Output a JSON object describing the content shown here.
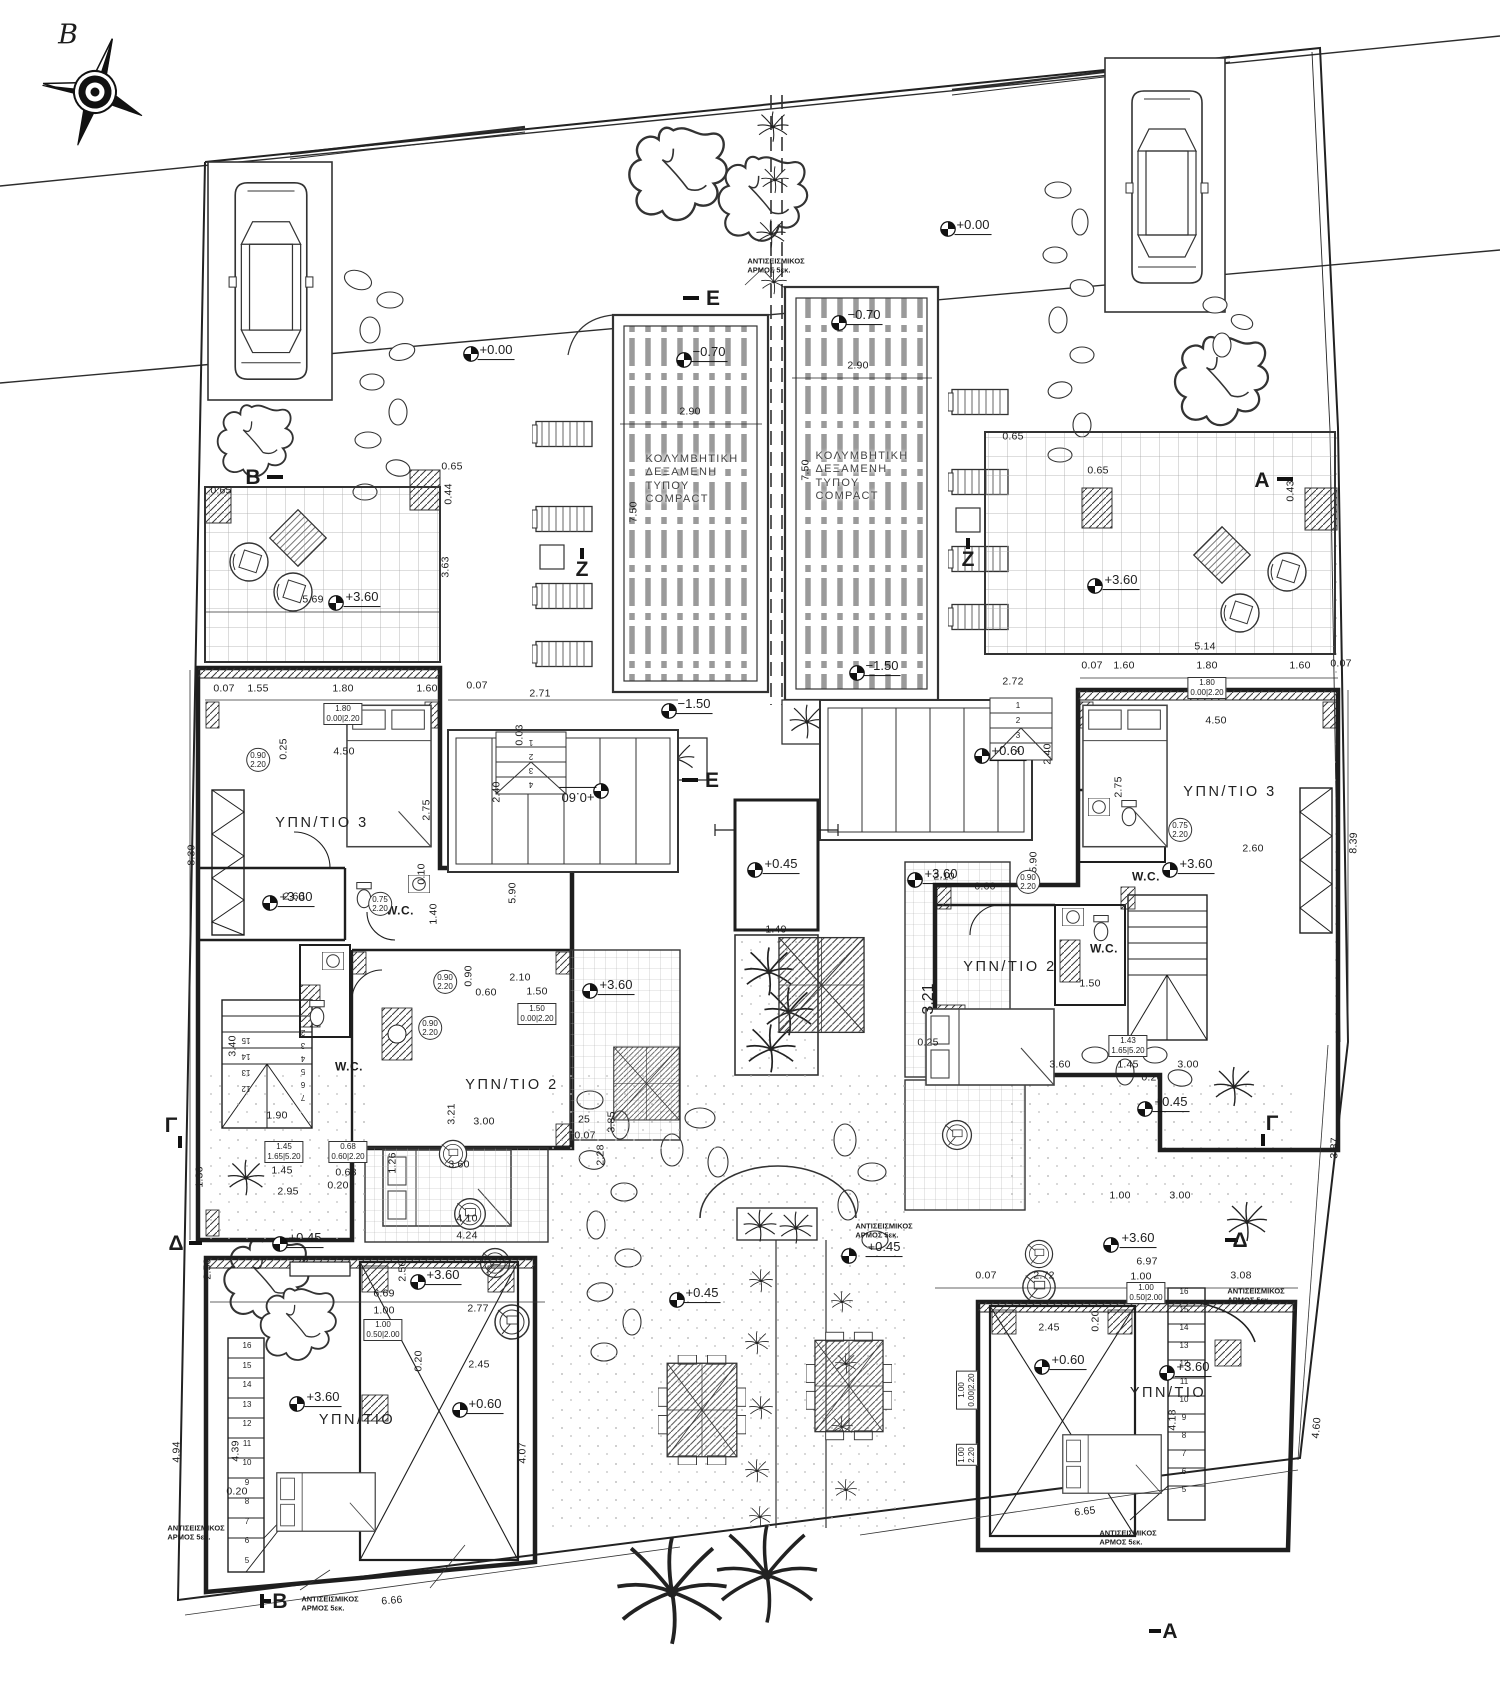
{
  "drawing": {
    "type": "architectural-floor-plan",
    "pool_label": "ΚΟΛΥΜΒΗΤΙΚΗ\nΔΕΞΑΜΕΝΗ\nΤΥΠΟΥ\nCOMPACT",
    "seismic_note": "ΑΝΤΙΣΕΙΣΜΙΚΟΣ\nΑΡΜΟΣ 5εκ.",
    "north_label": "B"
  },
  "annotations": [
    {
      "t": "B",
      "x": 68,
      "y": 36,
      "c": "north",
      "n": "north-label"
    },
    {
      "t": "B",
      "x": 253,
      "y": 478,
      "c": "sec",
      "n": "section-marker-b-top"
    },
    {
      "t": "B",
      "x": 280,
      "y": 1602,
      "c": "sec",
      "n": "section-marker-b-bottom"
    },
    {
      "t": "A",
      "x": 1262,
      "y": 481,
      "c": "sec",
      "n": "section-marker-a-top"
    },
    {
      "t": "A",
      "x": 1170,
      "y": 1632,
      "c": "sec",
      "n": "section-marker-a-bottom"
    },
    {
      "t": "Γ",
      "x": 171,
      "y": 1126,
      "c": "sec",
      "n": "section-marker-g-left"
    },
    {
      "t": "Γ",
      "x": 1272,
      "y": 1124,
      "c": "sec",
      "n": "section-marker-g-right"
    },
    {
      "t": "Δ",
      "x": 176,
      "y": 1244,
      "c": "sec",
      "n": "section-marker-d-left"
    },
    {
      "t": "Δ",
      "x": 1240,
      "y": 1241,
      "c": "sec",
      "n": "section-marker-d-right"
    },
    {
      "t": "E",
      "x": 713,
      "y": 299,
      "c": "sec",
      "n": "section-marker-e-top"
    },
    {
      "t": "E",
      "x": 712,
      "y": 781,
      "c": "sec",
      "n": "section-marker-e-mid"
    },
    {
      "t": "Z",
      "x": 582,
      "y": 570,
      "c": "sec",
      "n": "section-marker-z-left"
    },
    {
      "t": "Z",
      "x": 968,
      "y": 560,
      "c": "sec",
      "n": "section-marker-z-right"
    },
    {
      "t": "+0.00",
      "x": 973,
      "y": 226,
      "c": "lvl"
    },
    {
      "t": "+0.00",
      "x": 496,
      "y": 351,
      "c": "lvl"
    },
    {
      "t": "−0.70",
      "x": 709,
      "y": 353,
      "c": "lvl"
    },
    {
      "t": "−0.70",
      "x": 864,
      "y": 316,
      "c": "lvl"
    },
    {
      "t": "−1.50",
      "x": 694,
      "y": 705,
      "c": "lvl"
    },
    {
      "t": "−1.50",
      "x": 882,
      "y": 667,
      "c": "lvl"
    },
    {
      "t": "+3.60",
      "x": 362,
      "y": 598,
      "c": "lvl"
    },
    {
      "t": "+3.60",
      "x": 1121,
      "y": 581,
      "c": "lvl"
    },
    {
      "t": "+3.60",
      "x": 296,
      "y": 898,
      "c": "lvl"
    },
    {
      "t": "+3.60",
      "x": 616,
      "y": 986,
      "c": "lvl"
    },
    {
      "t": "+3.60",
      "x": 941,
      "y": 875,
      "c": "lvl"
    },
    {
      "t": "+3.60",
      "x": 1196,
      "y": 865,
      "c": "lvl"
    },
    {
      "t": "+0.60",
      "x": 578,
      "y": 796,
      "c": "lvl",
      "r": 180
    },
    {
      "t": "+0.60",
      "x": 1008,
      "y": 752,
      "c": "lvl"
    },
    {
      "t": "+0.45",
      "x": 781,
      "y": 865,
      "c": "lvl"
    },
    {
      "t": "+0.45",
      "x": 305,
      "y": 1239,
      "c": "lvl"
    },
    {
      "t": "+0.45",
      "x": 702,
      "y": 1294,
      "c": "lvl"
    },
    {
      "t": "+0.45",
      "x": 884,
      "y": 1248,
      "c": "lvl"
    },
    {
      "t": "+0.45",
      "x": 1171,
      "y": 1103,
      "c": "lvl"
    },
    {
      "t": "+3.60",
      "x": 323,
      "y": 1398,
      "c": "lvl"
    },
    {
      "t": "+3.60",
      "x": 443,
      "y": 1276,
      "c": "lvl"
    },
    {
      "t": "+0.60",
      "x": 485,
      "y": 1405,
      "c": "lvl"
    },
    {
      "t": "+3.60",
      "x": 1138,
      "y": 1239,
      "c": "lvl"
    },
    {
      "t": "+0.60",
      "x": 1068,
      "y": 1361,
      "c": "lvl"
    },
    {
      "t": "+3.60",
      "x": 1193,
      "y": 1368,
      "c": "lvl"
    },
    {
      "t": "ΥΠΝ/ΤΙΟ 3",
      "x": 322,
      "y": 824,
      "c": "room"
    },
    {
      "t": "ΥΠΝ/ΤΙΟ 3",
      "x": 1230,
      "y": 793,
      "c": "room"
    },
    {
      "t": "ΥΠΝ/ΤΙΟ 2",
      "x": 512,
      "y": 1086,
      "c": "room"
    },
    {
      "t": "ΥΠΝ/ΤΙΟ 2",
      "x": 1010,
      "y": 968,
      "c": "room"
    },
    {
      "t": "ΥΠΝ/ΤΙΟ",
      "x": 357,
      "y": 1421,
      "c": "room"
    },
    {
      "t": "ΥΠΝ/ΤΙΟ",
      "x": 1168,
      "y": 1394,
      "c": "room"
    },
    {
      "t": "W.C.",
      "x": 400,
      "y": 911,
      "c": "roomS"
    },
    {
      "t": "W.C.",
      "x": 349,
      "y": 1067,
      "c": "roomS"
    },
    {
      "t": "W.C.",
      "x": 1146,
      "y": 877,
      "c": "roomS"
    },
    {
      "t": "W.C.",
      "x": 1104,
      "y": 949,
      "c": "roomS"
    },
    {
      "t": "ΚΟΛΥΜΒΗΤΙΚΗ\nΔΕΞΑΜΕΝΗ\nΤΥΠΟΥ\nCOMPACT",
      "x": 692,
      "y": 480,
      "c": "pool",
      "n": "pool-label-left"
    },
    {
      "t": "ΚΟΛΥΜΒΗΤΙΚΗ\nΔΕΞΑΜΕΝΗ\nΤΥΠΟΥ\nCOMPACT",
      "x": 862,
      "y": 477,
      "c": "pool",
      "n": "pool-label-right"
    },
    {
      "t": "ΑΝΤΙΣΕΙΣΜΙΚΟΣ\nΑΡΜΟΣ 5εκ.",
      "x": 776,
      "y": 266,
      "c": "note",
      "n": "seismic-note"
    },
    {
      "t": "ΑΝΤΙΣΕΙΣΜΙΚΟΣ\nΑΡΜΟΣ 5εκ.",
      "x": 330,
      "y": 1604,
      "c": "note",
      "n": "seismic-note"
    },
    {
      "t": "ΑΝΤΙΣΕΙΣΜΙΚΟΣ\nΑΡΜΟΣ 5εκ.",
      "x": 196,
      "y": 1533,
      "c": "note",
      "n": "seismic-note"
    },
    {
      "t": "ΑΝΤΙΣΕΙΣΜΙΚΟΣ\nΑΡΜΟΣ 5εκ.",
      "x": 1256,
      "y": 1296,
      "c": "note",
      "n": "seismic-note"
    },
    {
      "t": "ΑΝΤΙΣΕΙΣΜΙΚΟΣ\nΑΡΜΟΣ 5εκ.",
      "x": 884,
      "y": 1231,
      "c": "note",
      "n": "seismic-note"
    },
    {
      "t": "ΑΝΤΙΣΕΙΣΜΙΚΟΣ\nΑΡΜΟΣ 5εκ.",
      "x": 1128,
      "y": 1538,
      "c": "note",
      "n": "seismic-note"
    },
    {
      "t": "2.90",
      "x": 690,
      "y": 412,
      "c": "dim"
    },
    {
      "t": "2.90",
      "x": 858,
      "y": 366,
      "c": "dim"
    },
    {
      "t": "7.50",
      "x": 634,
      "y": 512,
      "c": "dim",
      "r": -90
    },
    {
      "t": "7.50",
      "x": 806,
      "y": 470,
      "c": "dim",
      "r": -90
    },
    {
      "t": "0.65",
      "x": 452,
      "y": 467,
      "c": "dim"
    },
    {
      "t": "0.44",
      "x": 449,
      "y": 494,
      "c": "dim",
      "r": -90
    },
    {
      "t": "0.65",
      "x": 221,
      "y": 491,
      "c": "dim"
    },
    {
      "t": "0.65",
      "x": 1013,
      "y": 437,
      "c": "dim"
    },
    {
      "t": "0.43",
      "x": 1291,
      "y": 491,
      "c": "dim",
      "r": -90
    },
    {
      "t": "0.07",
      "x": 1341,
      "y": 664,
      "c": "dim"
    },
    {
      "t": "5.69",
      "x": 313,
      "y": 600,
      "c": "dim"
    },
    {
      "t": "3.63",
      "x": 446,
      "y": 567,
      "c": "dim",
      "r": -90
    },
    {
      "t": "0.07",
      "x": 224,
      "y": 689,
      "c": "dim"
    },
    {
      "t": "1.55",
      "x": 258,
      "y": 689,
      "c": "dim"
    },
    {
      "t": "1.80",
      "x": 343,
      "y": 689,
      "c": "dim"
    },
    {
      "t": "1.60",
      "x": 427,
      "y": 689,
      "c": "dim"
    },
    {
      "t": "1.80\n0.00|2.20",
      "x": 343,
      "y": 714,
      "c": "tag"
    },
    {
      "t": "8.39",
      "x": 192,
      "y": 855,
      "c": "dim",
      "r": -90
    },
    {
      "t": "8.39",
      "x": 1354,
      "y": 843,
      "c": "dim",
      "r": -88
    },
    {
      "t": "2.71",
      "x": 540,
      "y": 694,
      "c": "dim"
    },
    {
      "t": "0.07",
      "x": 477,
      "y": 686,
      "c": "dim"
    },
    {
      "t": "2.40",
      "x": 497,
      "y": 792,
      "c": "dim",
      "r": -90
    },
    {
      "t": "5.90",
      "x": 513,
      "y": 893,
      "c": "dim",
      "r": -90
    },
    {
      "t": "0.03",
      "x": 520,
      "y": 735,
      "c": "dim",
      "r": -90
    },
    {
      "t": "4.50",
      "x": 344,
      "y": 752,
      "c": "dim"
    },
    {
      "t": "2.75",
      "x": 427,
      "y": 810,
      "c": "dim",
      "r": -90
    },
    {
      "t": "2.60",
      "x": 294,
      "y": 897,
      "c": "dim"
    },
    {
      "t": "0.25",
      "x": 284,
      "y": 749,
      "c": "dim",
      "r": -90
    },
    {
      "t": "0.10",
      "x": 422,
      "y": 874,
      "c": "dim",
      "r": -90
    },
    {
      "t": "1.40",
      "x": 434,
      "y": 914,
      "c": "dim",
      "r": -90
    },
    {
      "t": "0.75\n2.20",
      "x": 380,
      "y": 904,
      "c": "tagc"
    },
    {
      "t": "0.90\n2.20",
      "x": 258,
      "y": 760,
      "c": "tagc"
    },
    {
      "t": "2.10",
      "x": 520,
      "y": 978,
      "c": "dim"
    },
    {
      "t": "1.50",
      "x": 537,
      "y": 992,
      "c": "dim"
    },
    {
      "t": "0.60",
      "x": 486,
      "y": 993,
      "c": "dim"
    },
    {
      "t": "0.90",
      "x": 469,
      "y": 976,
      "c": "dim",
      "r": -90
    },
    {
      "t": "1.50\n0.00|2.20",
      "x": 537,
      "y": 1014,
      "c": "tag"
    },
    {
      "t": "0.90\n2.20",
      "x": 430,
      "y": 1028,
      "c": "tagc"
    },
    {
      "t": "0.90\n2.20",
      "x": 445,
      "y": 982,
      "c": "tagc"
    },
    {
      "t": "3.00",
      "x": 484,
      "y": 1122,
      "c": "dim"
    },
    {
      "t": "3.21",
      "x": 452,
      "y": 1114,
      "c": "dim",
      "r": -90
    },
    {
      "t": "3.60",
      "x": 459,
      "y": 1165,
      "c": "dim"
    },
    {
      "t": "3.85",
      "x": 612,
      "y": 1122,
      "c": "dim",
      "r": -90
    },
    {
      "t": "25",
      "x": 584,
      "y": 1120,
      "c": "dim"
    },
    {
      "t": "0.07",
      "x": 585,
      "y": 1136,
      "c": "dim"
    },
    {
      "t": "2.28",
      "x": 601,
      "y": 1155,
      "c": "dim",
      "r": -90
    },
    {
      "t": "1.49",
      "x": 776,
      "y": 930,
      "c": "dim"
    },
    {
      "t": "2.10",
      "x": 944,
      "y": 877,
      "c": "dim"
    },
    {
      "t": "0.60",
      "x": 985,
      "y": 887,
      "c": "dim"
    },
    {
      "t": "1.50",
      "x": 1090,
      "y": 984,
      "c": "dim"
    },
    {
      "t": "3.21",
      "x": 929,
      "y": 999,
      "c": "d im",
      "r": -90
    },
    {
      "t": "3.60",
      "x": 1060,
      "y": 1065,
      "c": "dim"
    },
    {
      "t": "0.25",
      "x": 928,
      "y": 1043,
      "c": "dim"
    },
    {
      "t": "2.45",
      "x": 479,
      "y": 1365,
      "c": "dim"
    },
    {
      "t": "0.20",
      "x": 419,
      "y": 1361,
      "c": "dim",
      "r": -90
    },
    {
      "t": "2.45",
      "x": 1049,
      "y": 1328,
      "c": "dim"
    },
    {
      "t": "0.20",
      "x": 1096,
      "y": 1321,
      "c": "dim",
      "r": -90
    },
    {
      "t": "4.07",
      "x": 523,
      "y": 1453,
      "c": "dim",
      "r": -90
    },
    {
      "t": "4.18",
      "x": 1173,
      "y": 1420,
      "c": "dim",
      "r": -90
    },
    {
      "t": "6.69",
      "x": 384,
      "y": 1294,
      "c": "dim"
    },
    {
      "t": "1.00",
      "x": 384,
      "y": 1311,
      "c": "dim"
    },
    {
      "t": "2.77",
      "x": 478,
      "y": 1309,
      "c": "dim"
    },
    {
      "t": "1.00\n0.50|2.00",
      "x": 383,
      "y": 1330,
      "c": "tag"
    },
    {
      "t": "4.24",
      "x": 467,
      "y": 1236,
      "c": "dim"
    },
    {
      "t": "4.10",
      "x": 467,
      "y": 1219,
      "c": "dim"
    },
    {
      "t": "2.50",
      "x": 403,
      "y": 1271,
      "c": "dim",
      "r": -90
    },
    {
      "t": "2.50",
      "x": 208,
      "y": 1269,
      "c": "dim",
      "r": -90
    },
    {
      "t": "6.97",
      "x": 1147,
      "y": 1262,
      "c": "dim"
    },
    {
      "t": "1.00",
      "x": 1141,
      "y": 1277,
      "c": "dim"
    },
    {
      "t": "1.00\n0.50|2.00",
      "x": 1146,
      "y": 1293,
      "c": "tag"
    },
    {
      "t": "2.72",
      "x": 1044,
      "y": 1276,
      "c": "dim"
    },
    {
      "t": "3.08",
      "x": 1241,
      "y": 1276,
      "c": "dim"
    },
    {
      "t": "0.07",
      "x": 986,
      "y": 1276,
      "c": "dim"
    },
    {
      "t": "6.66",
      "x": 392,
      "y": 1601,
      "c": "dim",
      "r": -5
    },
    {
      "t": "6.65",
      "x": 1085,
      "y": 1512,
      "c": "dim",
      "r": -7
    },
    {
      "t": "4.94",
      "x": 177,
      "y": 1452,
      "c": "dim",
      "r": -90
    },
    {
      "t": "4.39",
      "x": 236,
      "y": 1451,
      "c": "dim",
      "r": -90
    },
    {
      "t": "0.20",
      "x": 237,
      "y": 1492,
      "c": "dim"
    },
    {
      "t": "4.60",
      "x": 1317,
      "y": 1428,
      "c": "dim",
      "r": -85
    },
    {
      "t": "3.87",
      "x": 1335,
      "y": 1148,
      "c": "dim",
      "r": -88
    },
    {
      "t": "2.95",
      "x": 288,
      "y": 1192,
      "c": "dim"
    },
    {
      "t": "1.45",
      "x": 282,
      "y": 1171,
      "c": "dim"
    },
    {
      "t": "0.68",
      "x": 346,
      "y": 1173,
      "c": "dim"
    },
    {
      "t": "0.20",
      "x": 338,
      "y": 1186,
      "c": "dim"
    },
    {
      "t": "1.45\n1.65|5.20",
      "x": 284,
      "y": 1152,
      "c": "tag"
    },
    {
      "t": "0.68\n0.60|2.20",
      "x": 348,
      "y": 1152,
      "c": "tag"
    },
    {
      "t": "1.36",
      "x": 200,
      "y": 1177,
      "c": "dim",
      "r": -90
    },
    {
      "t": "1.90",
      "x": 277,
      "y": 1116,
      "c": "dim"
    },
    {
      "t": "3.40",
      "x": 233,
      "y": 1046,
      "c": "dim",
      "r": -90
    },
    {
      "t": "1.26",
      "x": 393,
      "y": 1163,
      "c": "dim",
      "r": -90
    },
    {
      "t": "5.14",
      "x": 1205,
      "y": 647,
      "c": "dim"
    },
    {
      "t": "0.07",
      "x": 1092,
      "y": 666,
      "c": "dim"
    },
    {
      "t": "1.60",
      "x": 1124,
      "y": 666,
      "c": "dim"
    },
    {
      "t": "1.80",
      "x": 1207,
      "y": 666,
      "c": "dim"
    },
    {
      "t": "1.60",
      "x": 1300,
      "y": 666,
      "c": "dim"
    },
    {
      "t": "1.80\n0.00|2.20",
      "x": 1207,
      "y": 688,
      "c": "tag"
    },
    {
      "t": "4.50",
      "x": 1216,
      "y": 721,
      "c": "dim"
    },
    {
      "t": "2.75",
      "x": 1119,
      "y": 787,
      "c": "dim",
      "r": -90
    },
    {
      "t": "2.60",
      "x": 1253,
      "y": 849,
      "c": "dim"
    },
    {
      "t": "2.72",
      "x": 1013,
      "y": 682,
      "c": "dim"
    },
    {
      "t": "2.40",
      "x": 1048,
      "y": 754,
      "c": "dim",
      "r": -90
    },
    {
      "t": "5.90",
      "x": 1034,
      "y": 862,
      "c": "dim",
      "r": -90
    },
    {
      "t": "0.65",
      "x": 1098,
      "y": 471,
      "c": "dim"
    },
    {
      "t": "1.45",
      "x": 1128,
      "y": 1065,
      "c": "dim"
    },
    {
      "t": "3.00",
      "x": 1188,
      "y": 1065,
      "c": "dim"
    },
    {
      "t": "0.20",
      "x": 1152,
      "y": 1078,
      "c": "dim"
    },
    {
      "t": "1.43\n1.65|5.20",
      "x": 1128,
      "y": 1046,
      "c": "tag"
    },
    {
      "t": "1.00",
      "x": 1120,
      "y": 1196,
      "c": "dim"
    },
    {
      "t": "3.00",
      "x": 1180,
      "y": 1196,
      "c": "dim"
    },
    {
      "t": "0.75\n2.20",
      "x": 1180,
      "y": 830,
      "c": "tagc"
    },
    {
      "t": "0.90\n2.20",
      "x": 1028,
      "y": 882,
      "c": "tagc"
    },
    {
      "t": "1.00\n0.00|2.20",
      "x": 967,
      "y": 1390,
      "c": "tag",
      "r": -90
    },
    {
      "t": "1.00\n2.20",
      "x": 967,
      "y": 1455,
      "c": "tag",
      "r": -90
    }
  ],
  "sequences": [
    {
      "texts": [
        "16",
        "15",
        "14",
        "13",
        "12",
        "11",
        "10",
        "9",
        "8",
        "7",
        "6",
        "5"
      ],
      "x": 247,
      "y": 1346,
      "dy": 19.5,
      "n": "stair-numbers-bottom-left"
    },
    {
      "texts": [
        "16",
        "15",
        "14",
        "13",
        "12",
        "11",
        "10",
        "9",
        "8",
        "7",
        "6",
        "5"
      ],
      "x": 1184,
      "y": 1292,
      "dy": 18,
      "n": "stair-numbers-bottom-right"
    },
    {
      "texts": [
        "15",
        "14",
        "13",
        "12"
      ],
      "x": 246,
      "y": 1040,
      "dy": 16,
      "r": 180,
      "n": "stair-numbers-mid-left-a"
    },
    {
      "texts": [
        "2",
        "3",
        "4",
        "5",
        "6",
        "7"
      ],
      "x": 303,
      "y": 1032,
      "dy": 13,
      "r": 180,
      "n": "stair-numbers-mid-left-b"
    },
    {
      "texts": [
        "1",
        "2",
        "3",
        "4"
      ],
      "x": 531,
      "y": 742,
      "dy": 14,
      "r": 180,
      "n": "step-numbers-center-left"
    },
    {
      "texts": [
        "1",
        "2",
        "3",
        "4"
      ],
      "x": 1018,
      "y": 706,
      "dy": 15,
      "n": "step-numbers-center-right"
    }
  ],
  "level_markers": [
    {
      "x": 948,
      "y": 229
    },
    {
      "x": 471,
      "y": 354
    },
    {
      "x": 684,
      "y": 360
    },
    {
      "x": 839,
      "y": 323
    },
    {
      "x": 669,
      "y": 711
    },
    {
      "x": 857,
      "y": 673
    },
    {
      "x": 336,
      "y": 603
    },
    {
      "x": 1095,
      "y": 586
    },
    {
      "x": 270,
      "y": 903
    },
    {
      "x": 590,
      "y": 991
    },
    {
      "x": 915,
      "y": 880
    },
    {
      "x": 1170,
      "y": 870
    },
    {
      "x": 601,
      "y": 791
    },
    {
      "x": 982,
      "y": 756
    },
    {
      "x": 755,
      "y": 870
    },
    {
      "x": 280,
      "y": 1244
    },
    {
      "x": 677,
      "y": 1300
    },
    {
      "x": 849,
      "y": 1256
    },
    {
      "x": 1145,
      "y": 1109
    },
    {
      "x": 297,
      "y": 1404
    },
    {
      "x": 418,
      "y": 1282
    },
    {
      "x": 460,
      "y": 1410
    },
    {
      "x": 1111,
      "y": 1245
    },
    {
      "x": 1042,
      "y": 1367
    },
    {
      "x": 1167,
      "y": 1373
    }
  ]
}
